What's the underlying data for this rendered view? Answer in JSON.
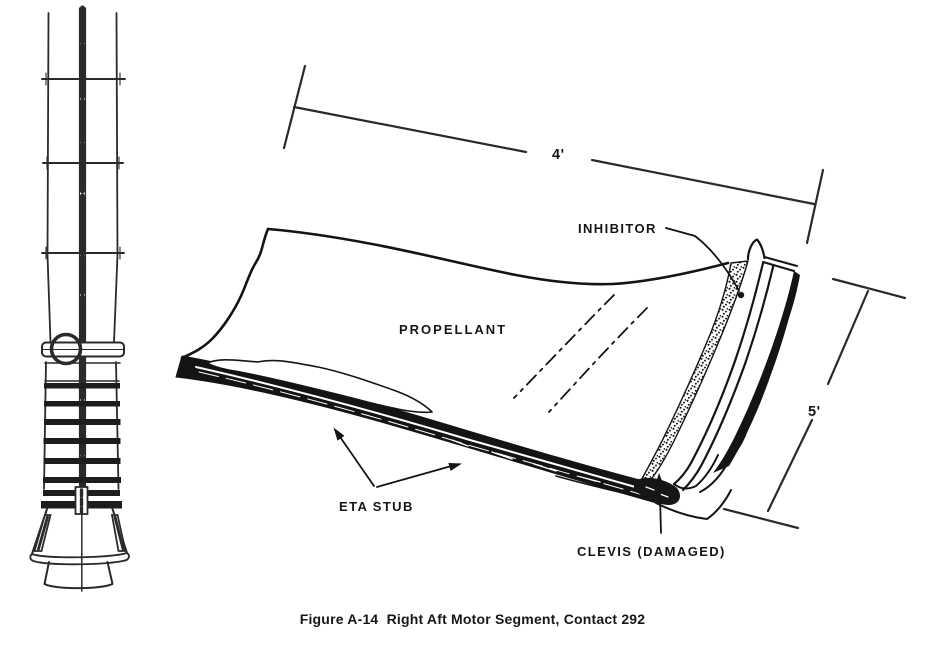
{
  "page": {
    "background": "#ffffff",
    "ink_color": "#141414"
  },
  "caption": {
    "text": "Figure A-14  Right Aft Motor Segment, Contact 292"
  },
  "sketch": {
    "labels": {
      "inhibitor": "INHIBITOR",
      "propellant": "PROPELLANT",
      "eta_stub": "ETA STUB",
      "clevis": "CLEVIS (DAMAGED)"
    },
    "dimensions": {
      "width": "4'",
      "height": "5'"
    }
  },
  "drawings": {
    "thumbnail": "solid-rocket-booster-side-view",
    "main": "right-aft-motor-segment-fragment"
  }
}
